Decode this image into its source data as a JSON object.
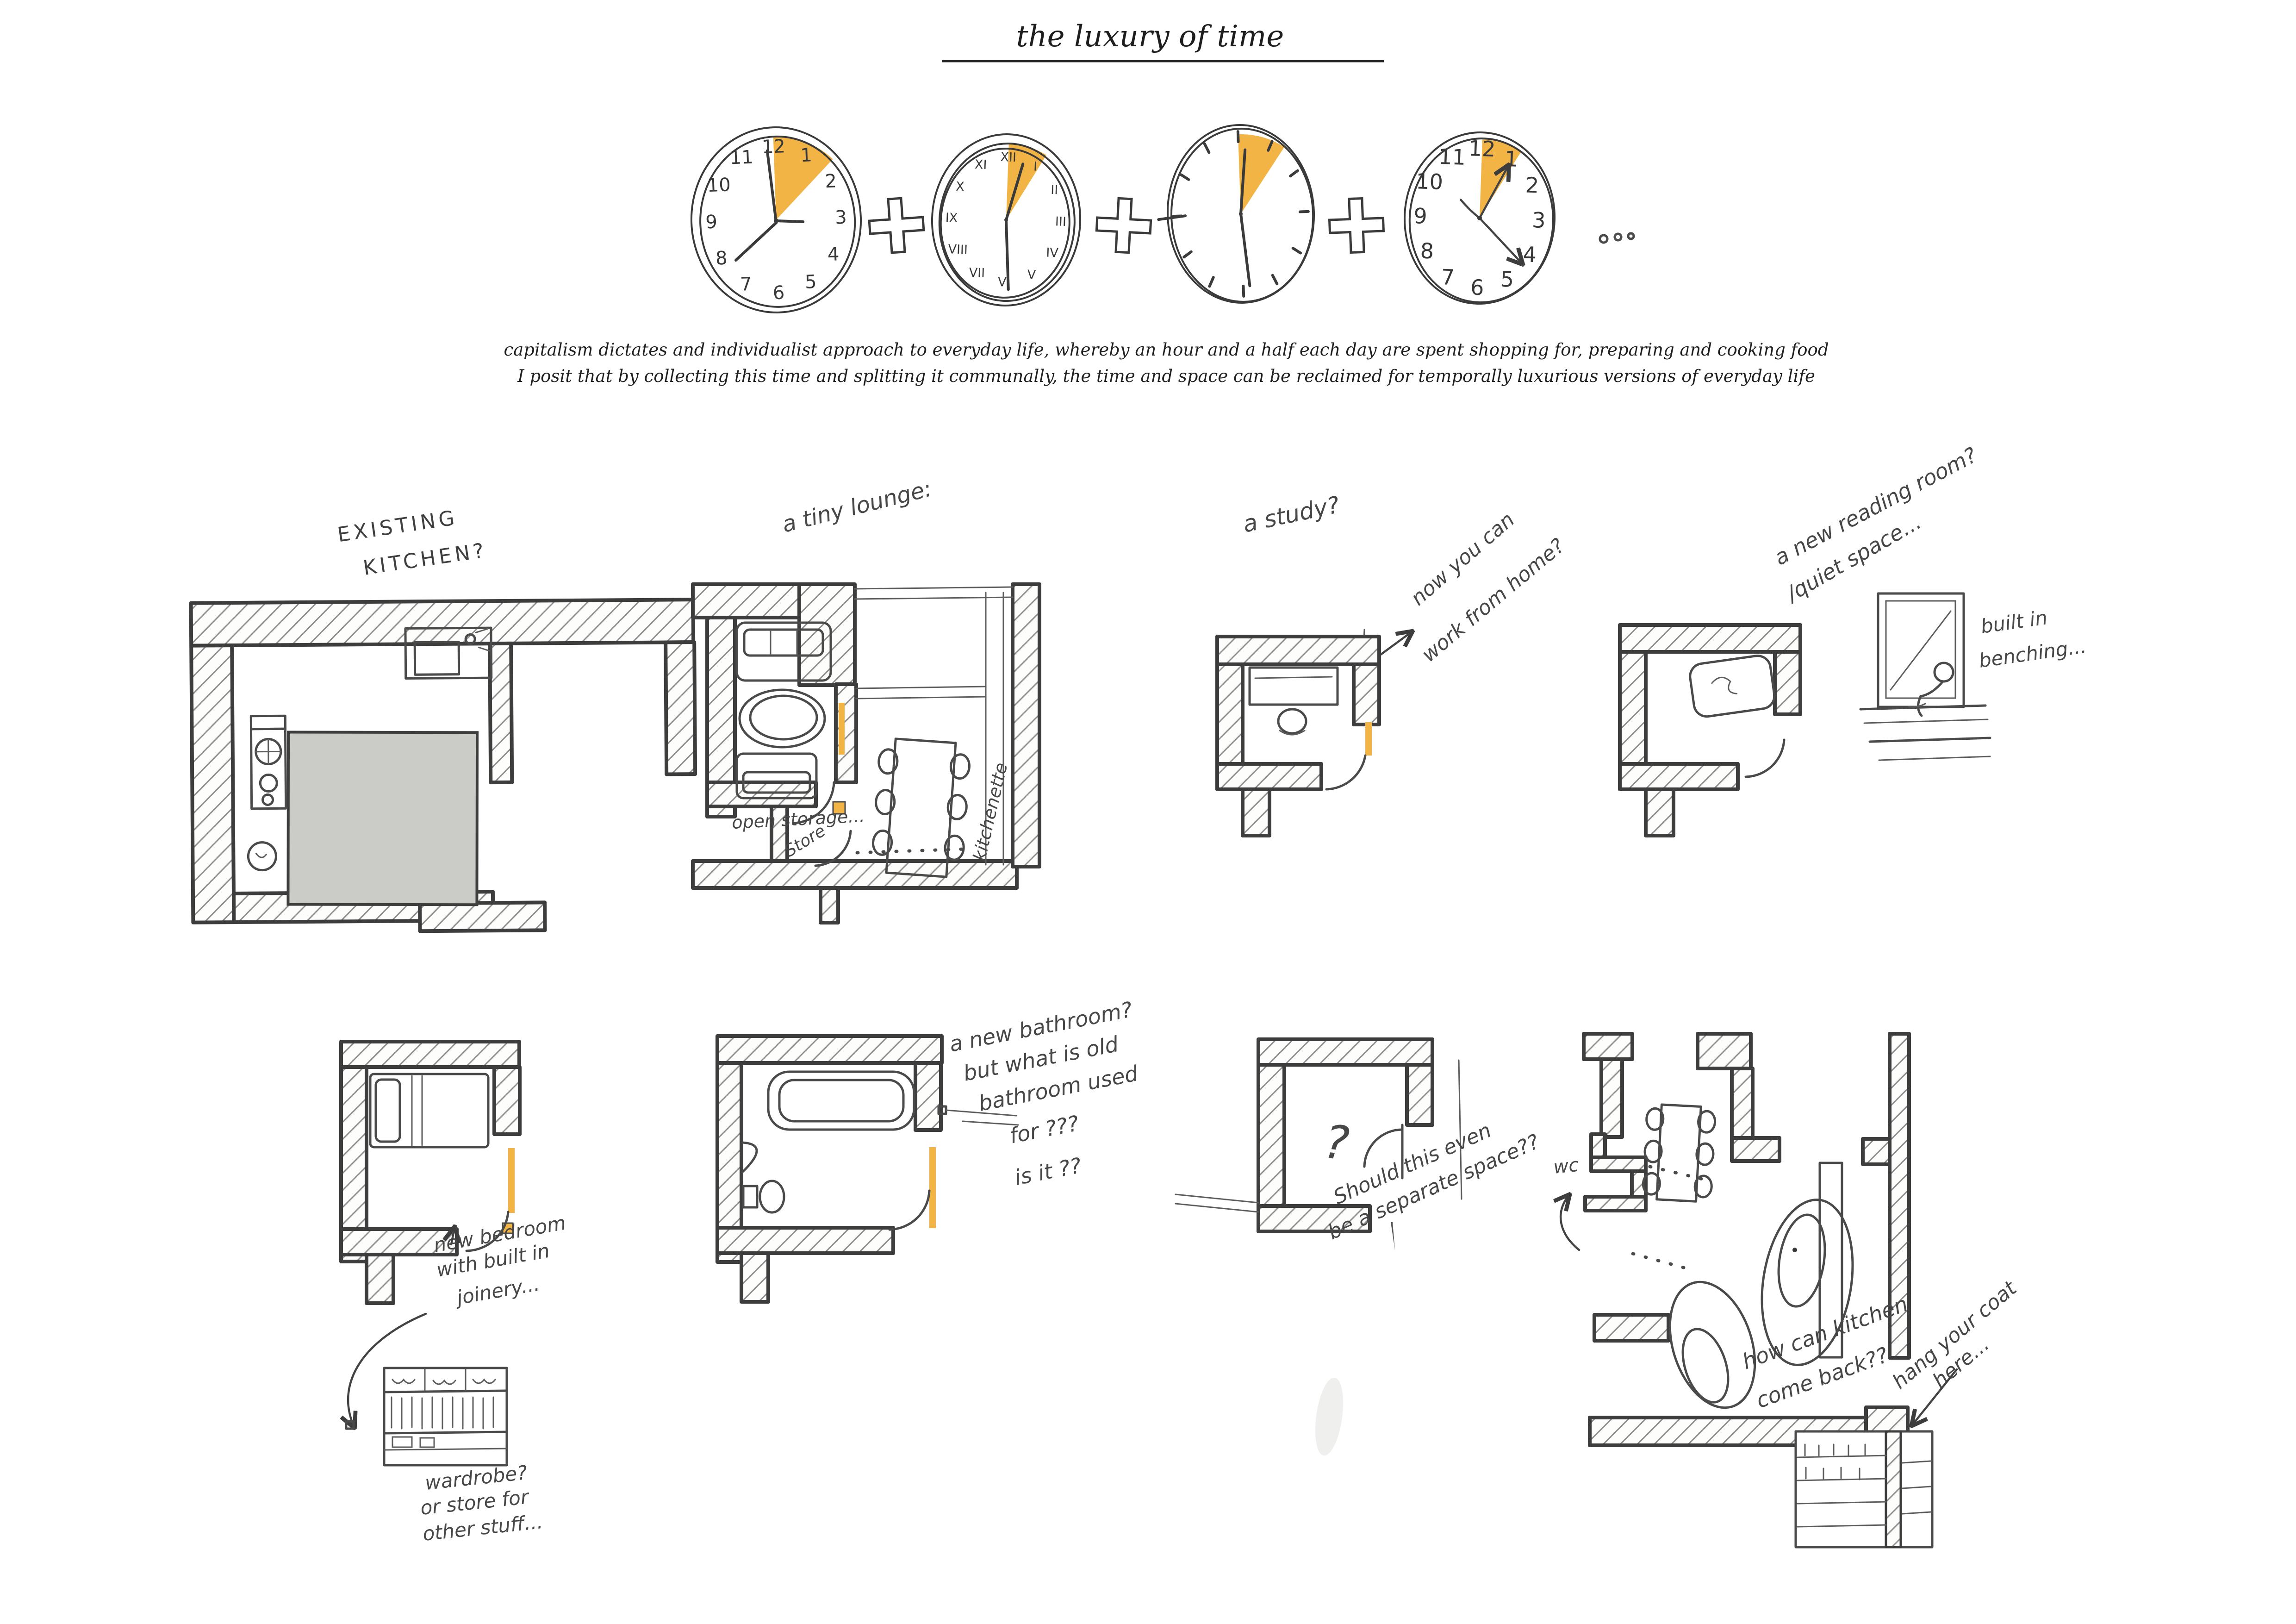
{
  "title": "the luxury of  time",
  "caption": {
    "line1": "capitalism dictates and individualist approach to everyday life, whereby an hour and a half each day are spent shopping for, preparing and cooking food",
    "line2": "I posit that by collecting this time and splitting it communally, the time and space can be reclaimed for temporally luxurious versions of everyday life"
  },
  "clocks": {
    "arabic": [
      "12",
      "1",
      "2",
      "3",
      "4",
      "5",
      "6",
      "7",
      "8",
      "9",
      "10",
      "11"
    ],
    "roman": [
      "XII",
      "I",
      "II",
      "III",
      "IV",
      "V",
      "VI",
      "VII",
      "VIII",
      "IX",
      "X",
      "XI"
    ]
  },
  "panels": {
    "kitchen": {
      "label1": "EXISTING",
      "label2": "KITCHEN?"
    },
    "lounge": {
      "label": "a tiny lounge:",
      "store": "Store",
      "open_storage": "open storage...",
      "kitchenette": "kitchenette"
    },
    "study": {
      "label": "a study?",
      "note1": "now you can",
      "note2": "work from home?"
    },
    "reading": {
      "label1": "a new reading room?",
      "label2": "/quiet space...",
      "bench1": "built in",
      "bench2": "benching..."
    },
    "bedroom": {
      "note1": "new bedroom",
      "note2": "with built in",
      "note3": "joinery...",
      "wardrobe1": "wardrobe?",
      "wardrobe2": "or store for",
      "wardrobe3": "other stuff..."
    },
    "bathroom": {
      "note1": "a new bathroom?",
      "note2": "but what is old",
      "note3": "bathroom used",
      "note4": "for ???",
      "note5": "is it ??"
    },
    "separate": {
      "question": "?",
      "note1": "Should this even",
      "note2": "be a separate space??"
    },
    "communal": {
      "wc": "wc",
      "note1": "how can kitchen",
      "note2": "come back??",
      "coat1": "hang your coat",
      "coat2": "here..."
    }
  },
  "colors": {
    "accent": "#F2B545",
    "ink": "#3D3D3D",
    "hatch": "#8E8E8E",
    "gray_fill": "#CBCBC8"
  }
}
